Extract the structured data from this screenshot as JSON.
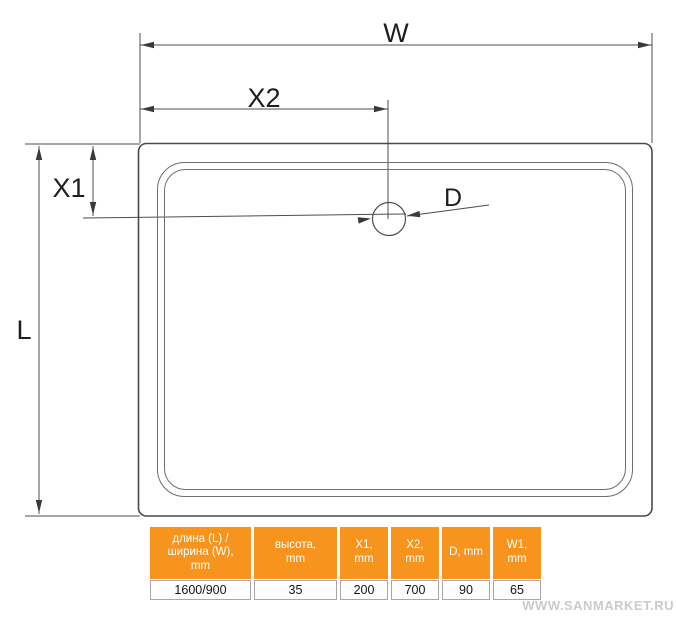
{
  "diagram": {
    "labels": {
      "w": "W",
      "x2": "X2",
      "x1": "X1",
      "l": "L",
      "d": "D"
    }
  },
  "table": {
    "columns": [
      {
        "header": "длина (L) /\nширина (W),\nmm",
        "value": "1600/900"
      },
      {
        "header": "высота,\nmm",
        "value": "35"
      },
      {
        "header": "X1,\nmm",
        "value": "200"
      },
      {
        "header": "X2,\nmm",
        "value": "700"
      },
      {
        "header": "D, mm",
        "value": "90"
      },
      {
        "header": "W1,\nmm",
        "value": "65"
      }
    ]
  },
  "watermark": "WWW.SANMARKET.RU",
  "colors": {
    "accent": "#F7941E",
    "line": "#4d4d4d",
    "watermark": "#cbcbcb"
  }
}
